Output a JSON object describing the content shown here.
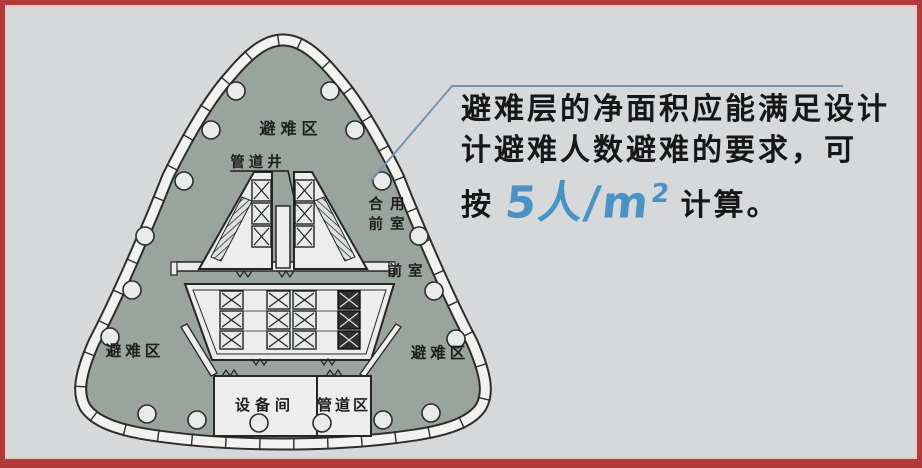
{
  "annotation": {
    "line1": "避难层的净面积应能满足设计",
    "line2": "计避难人数避难的要求，可",
    "line3_prefix": "按",
    "rate_main": "5人/m",
    "rate_sup": "2",
    "line3_suffix": "计算。"
  },
  "plan": {
    "labels": {
      "refuge_top": "避难区",
      "refuge_left": "避难区",
      "refuge_right": "避难区",
      "pipe_shaft": "管道井",
      "shared_lobby_line1": "合用",
      "shared_lobby_line2": "前室",
      "lobby": "前室",
      "equipment_room": "设备间",
      "pipe_zone": "管道区"
    }
  },
  "colors": {
    "frame_red": "#b23a3b",
    "background_gray": "#d7d8d9",
    "plan_fill": "#9aa49f",
    "wall_white": "#f2f3f1",
    "line_dark": "#2d2d2d",
    "callout_blue": "#7a93ad",
    "rate_blue": "#4a92c4",
    "text_dark": "#171717"
  }
}
